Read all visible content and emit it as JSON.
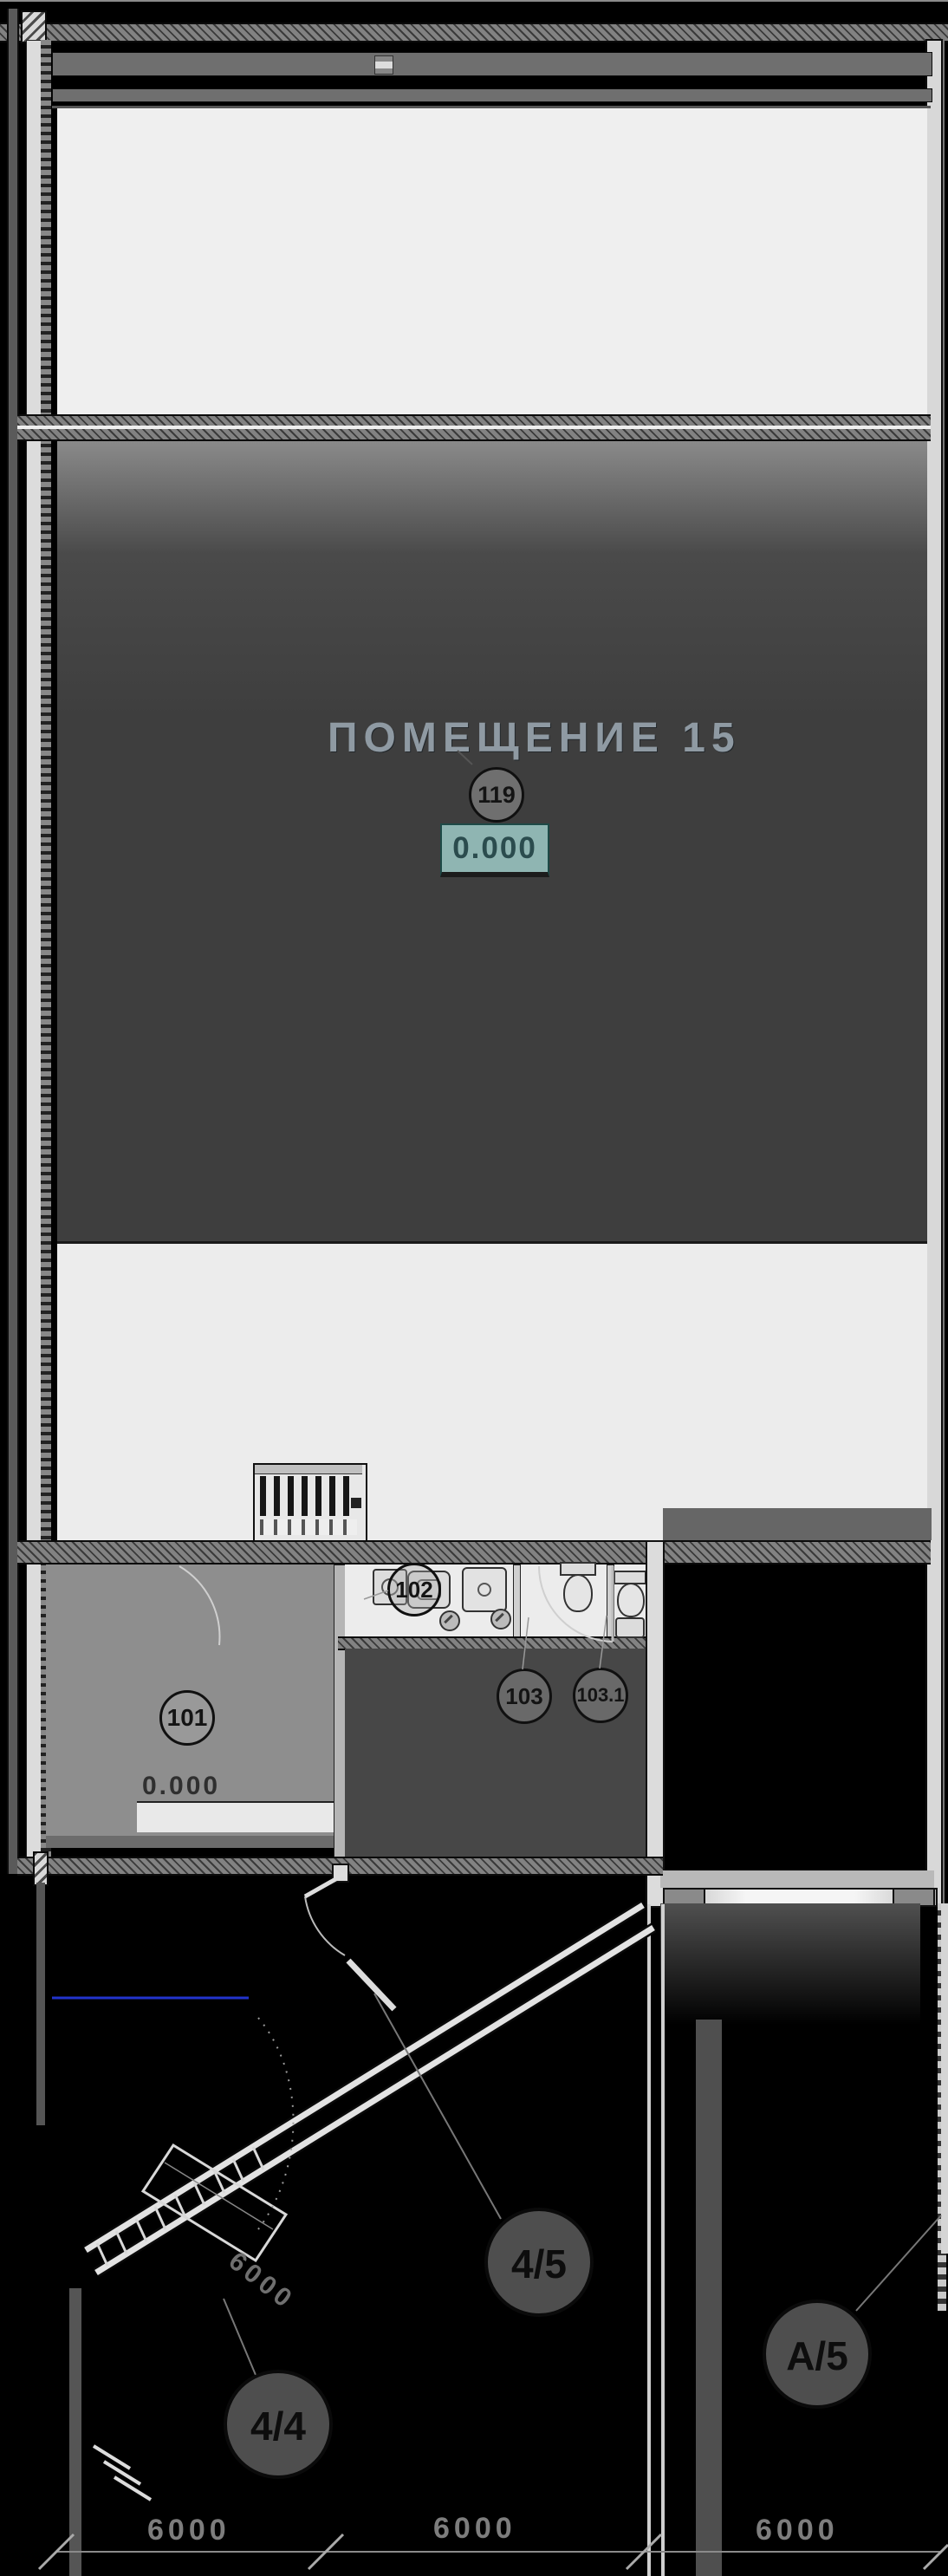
{
  "drawing": {
    "main_room": {
      "title": "ПОМЕЩЕНИЕ 15",
      "number": "119",
      "elevation": "0.000"
    },
    "rooms": [
      {
        "number": "101",
        "elevation": "0.000"
      },
      {
        "number": "102"
      },
      {
        "number": "103"
      },
      {
        "number": "103.1"
      }
    ],
    "grid_axes": [
      {
        "label": "4/5"
      },
      {
        "label": "А/5"
      },
      {
        "label": "4/4"
      }
    ],
    "dimensions": {
      "bottom": [
        "6000",
        "6000",
        "6000"
      ],
      "diagonal": "6000"
    },
    "colors": {
      "elevation_box": "#8fb5b2",
      "reference_line": "#2233cc",
      "background": "#000000"
    }
  }
}
